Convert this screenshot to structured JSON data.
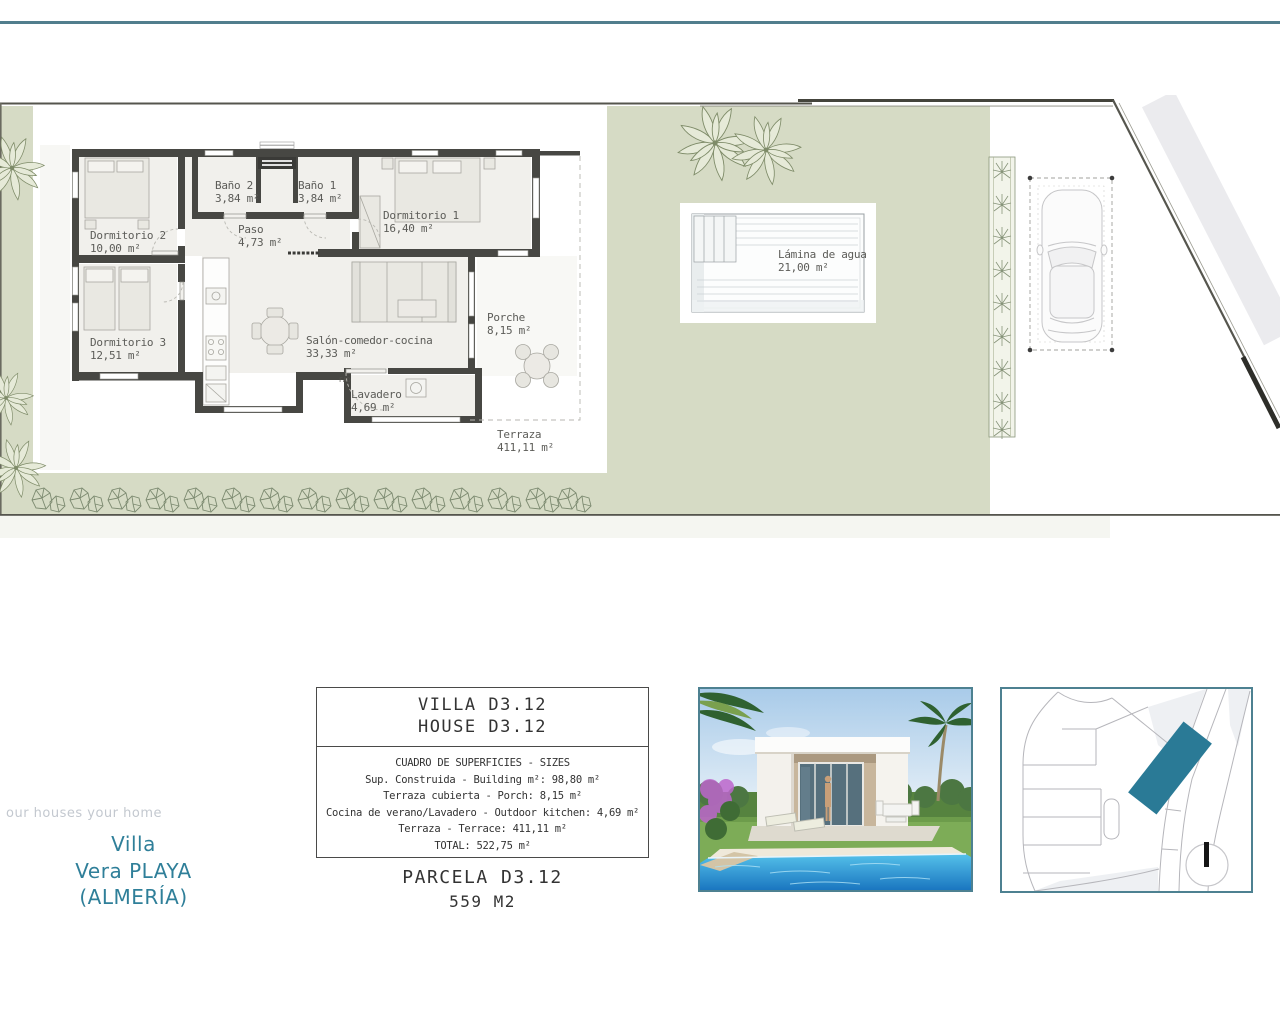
{
  "branding": {
    "tagline": "our houses your home",
    "project": [
      "Villa",
      "Vera PLAYA",
      "(ALMERÍA)"
    ]
  },
  "plan": {
    "rooms": [
      {
        "name": "Baño 2",
        "area": "3,84 m²"
      },
      {
        "name": "Baño 1",
        "area": "3,84 m²"
      },
      {
        "name": "Paso",
        "area": "4,73 m²"
      },
      {
        "name": "Dormitorio 2",
        "area": "10,00 m²"
      },
      {
        "name": "Dormitorio 1",
        "area": "16,40 m²"
      },
      {
        "name": "Dormitorio 3",
        "area": "12,51 m²"
      },
      {
        "name": "Salón-comedor-cocina",
        "area": "33,33 m²"
      },
      {
        "name": "Porche",
        "area": "8,15 m²"
      },
      {
        "name": "Lavadero",
        "area": "4,69 m²"
      },
      {
        "name": "Terraza",
        "area": "411,11 m²"
      }
    ],
    "pool": {
      "name": "Lámina de agua",
      "area": "21,00 m²"
    },
    "laundry_tag": "FAD"
  },
  "info_box": {
    "title_line1": "VILLA D3.12",
    "title_line2": "HOUSE D3.12",
    "lines": [
      "CUADRO DE SUPERFICIES  - SIZES",
      "Sup. Construida  - Building m²: 98,80 m²",
      "Terraza cubierta  - Porch: 8,15 m²",
      "Cocina de verano/Lavadero  - Outdoor kitchen: 4,69 m²",
      "Terraza - Terrace: 411,11 m²",
      "TOTAL:  522,75 m²"
    ],
    "parcel_title": "PARCELA D3.12",
    "parcel_area": "559 M2"
  },
  "colors": {
    "accent_teal": "#4d8191",
    "title_teal": "#2f7f99",
    "sage_green": "#d6dbc5",
    "plot_highlight": "#2a7a96",
    "wall": "#474743"
  }
}
